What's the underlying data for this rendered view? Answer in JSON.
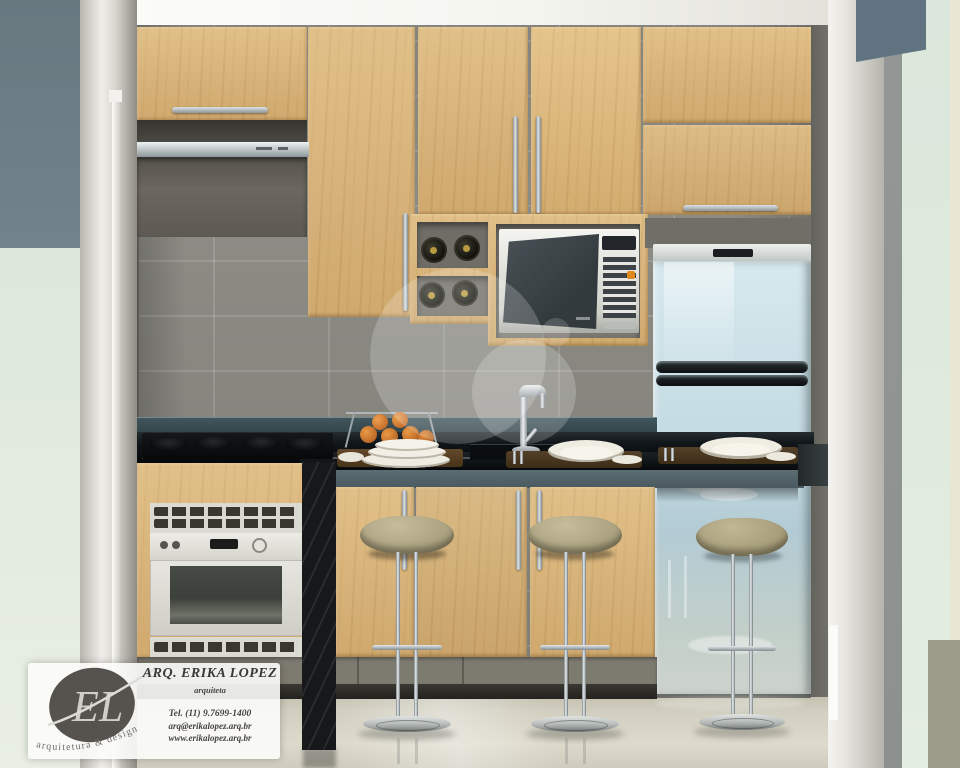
{
  "card": {
    "title": "ARQ. ERIKA LOPEZ",
    "subtitle": "arquiteta",
    "phone": "Tel. (11) 9.7699-1400",
    "email": "arq@erikalopez.arq.br",
    "website": "www.erikalopez.arq.br",
    "monogram": "EL",
    "tagline": "arquitetura & design"
  },
  "palette": {
    "cabinet_wood": "#d7b277",
    "wall_tile_gray": "#8c8b84",
    "countertop_black": "#101416",
    "backsplash_teal": "#3a4e54",
    "bar_fascia_teal": "#53646a",
    "floor_beige": "#d2cfc0",
    "left_wall_slate": "#6d7e88",
    "side_wall_mint": "#dfe9dc",
    "side_wall_cream": "#e9e6d4",
    "stainless": "#c7d0d3",
    "stool_cushion": "#b2a98a",
    "fridge_reflection_blue": "#c9dee5",
    "accent_orange_button": "#e08820",
    "fruit_orange": "#d2722a"
  }
}
